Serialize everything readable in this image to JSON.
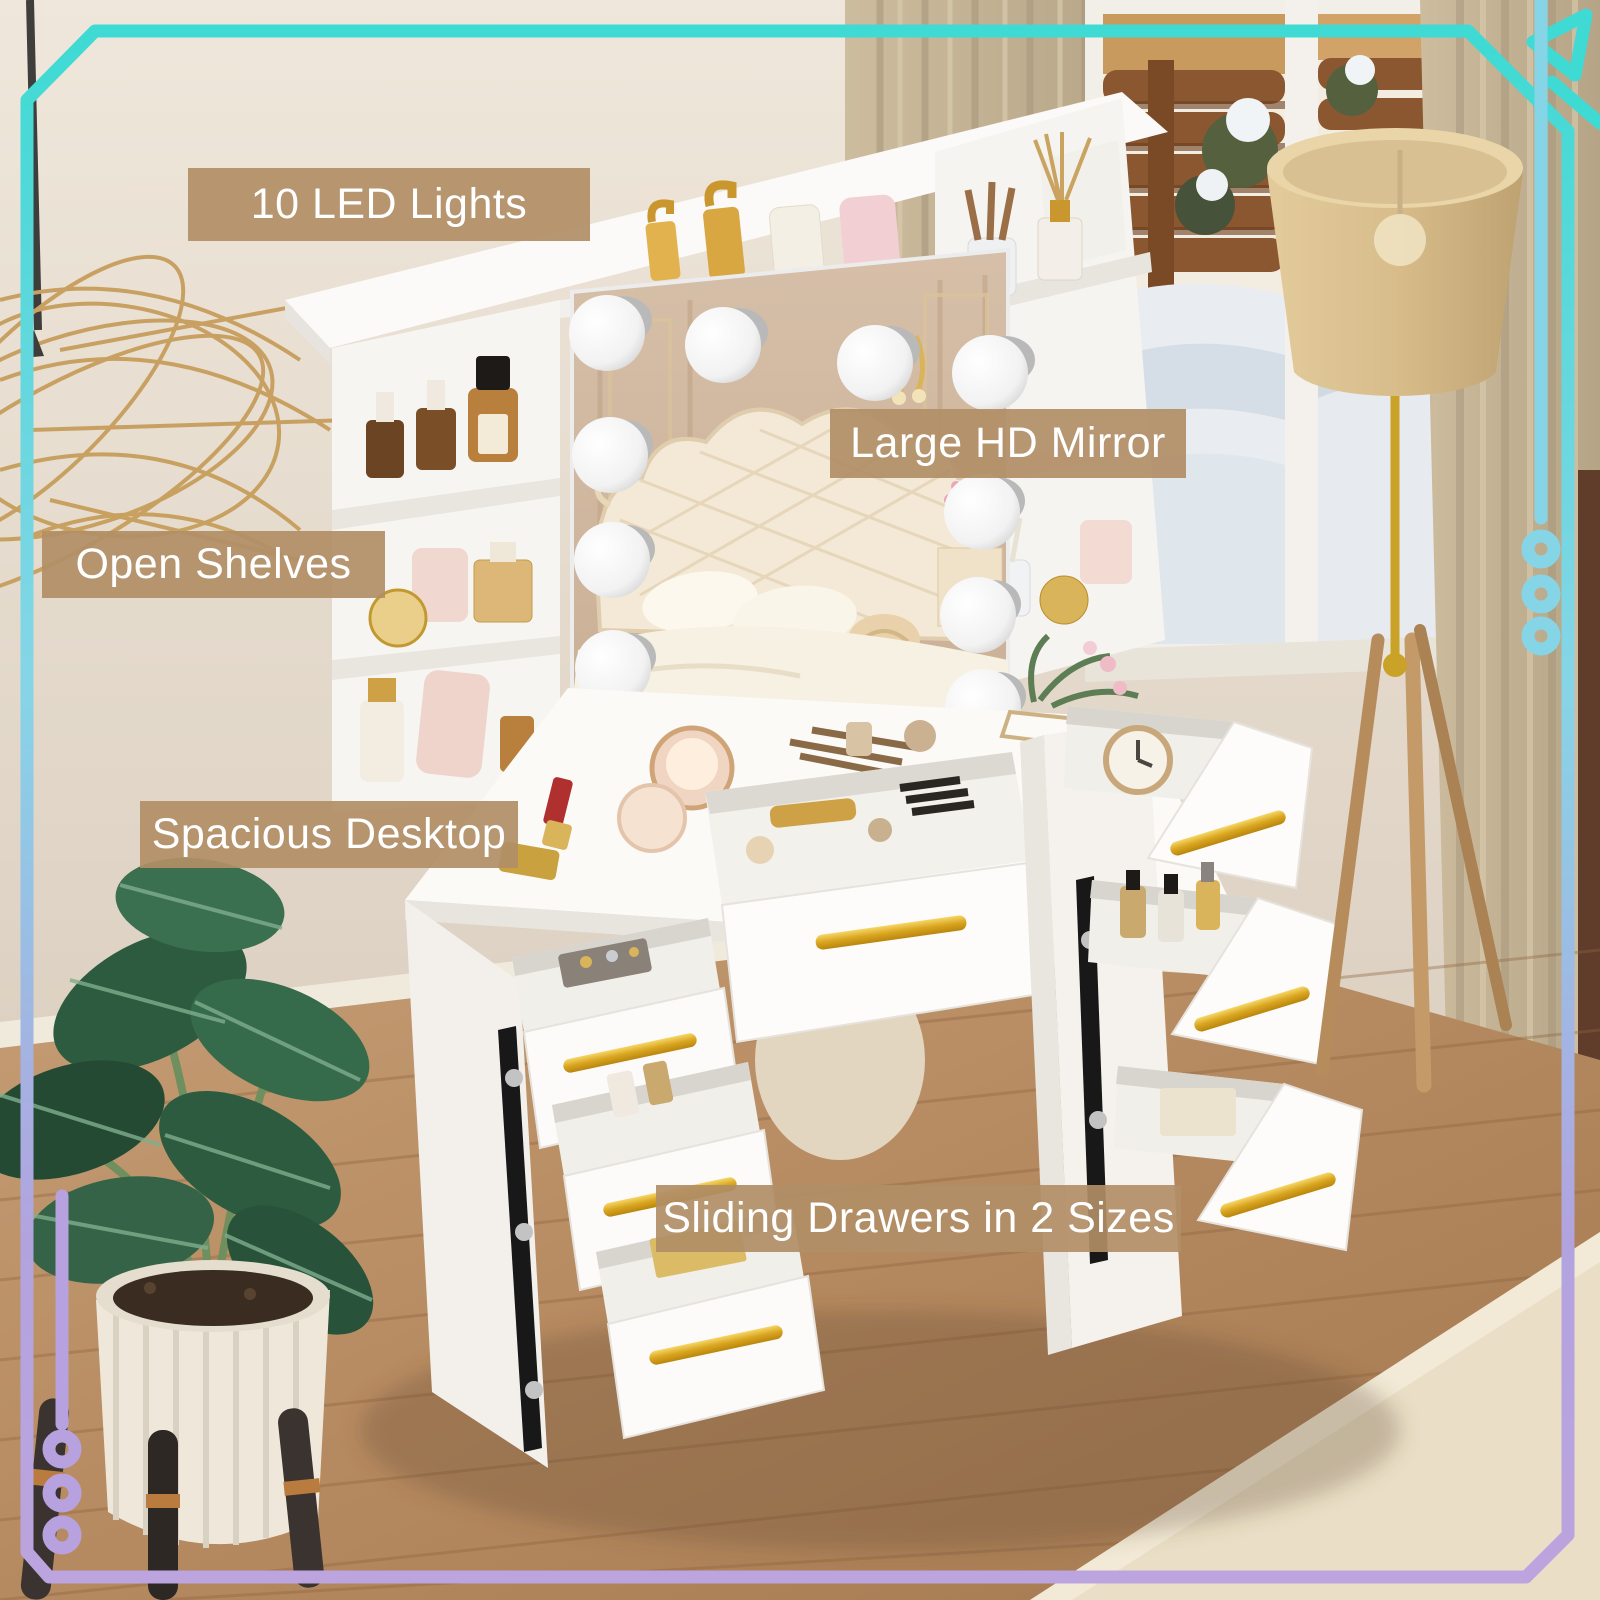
{
  "page": {
    "title": "Vanity desk feature highlights"
  },
  "labels": {
    "led_lights": "10 LED Lights",
    "hd_mirror": "Large HD Mirror",
    "open_shelves": "Open Shelves",
    "spacious_desktop": "Spacious Desktop",
    "sliding_drawers": "Sliding Drawers in 2 Sizes"
  },
  "product": {
    "led_bulb_count": "10"
  },
  "colors": {
    "frame-teal": "#3EDAD3",
    "frame-blue": "#86D5E7",
    "frame-purple": "#B7A1DE",
    "label-bg": "#B18E66",
    "label-text": "#FFFFFF",
    "handle-gold": "#D9A520",
    "furniture-white": "#F8F6F3"
  }
}
